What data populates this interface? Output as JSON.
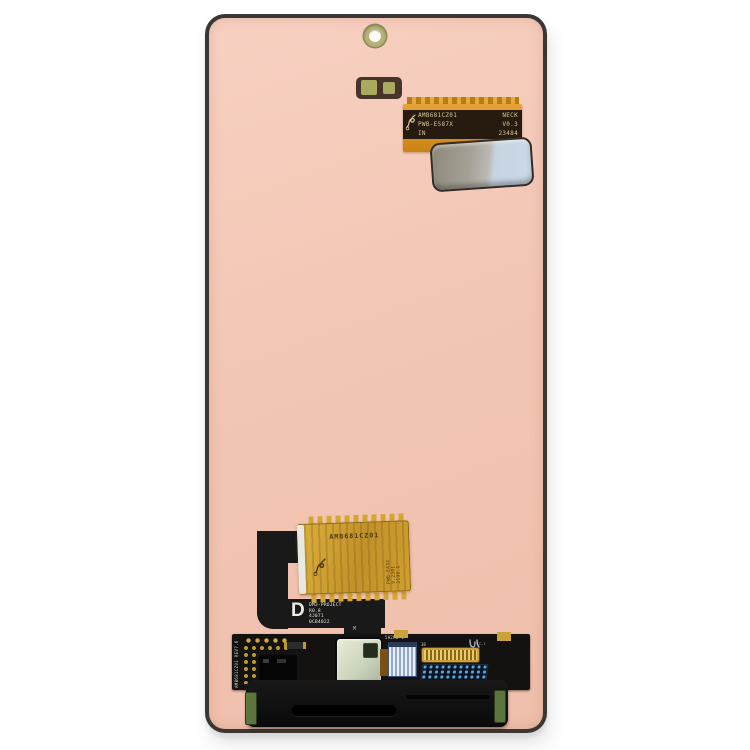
{
  "photo": {
    "background_color": "#ffffff",
    "subject": "smartphone display assembly rear view"
  },
  "device": {
    "frame_color": "#3a3633",
    "panel_color": "#f3c6b4"
  },
  "top_flex": {
    "flex_color": "#e09a28",
    "sticker_colors": [
      "#a6a196",
      "#ccdae8"
    ],
    "label": {
      "line1_left": "AMB681CZ01",
      "line1_right": "NECK",
      "line2_left": "PWB-E587X",
      "line2_right": "V0.3",
      "line3_left": "IN",
      "line3_right": "23484"
    }
  },
  "driver_board": {
    "board_color": "#cda22c",
    "part_number": "AMB681CZ01",
    "side_lines": [
      "PWB-EA32",
      "V.2301",
      "2190.1"
    ]
  },
  "main_flex": {
    "revision_letter": "D",
    "label_lines": [
      "DM3-PROJECT",
      "R0.8",
      "4J071",
      "0CB4022"
    ],
    "stem_marking": "M"
  },
  "bottom_board": {
    "board_color": "#141210",
    "edge_marking": "AMB681CZ01 REV7.6",
    "connector_marking": "5H2HB 1",
    "pin_count_marking": "38",
    "logo_marking": "C-1"
  }
}
